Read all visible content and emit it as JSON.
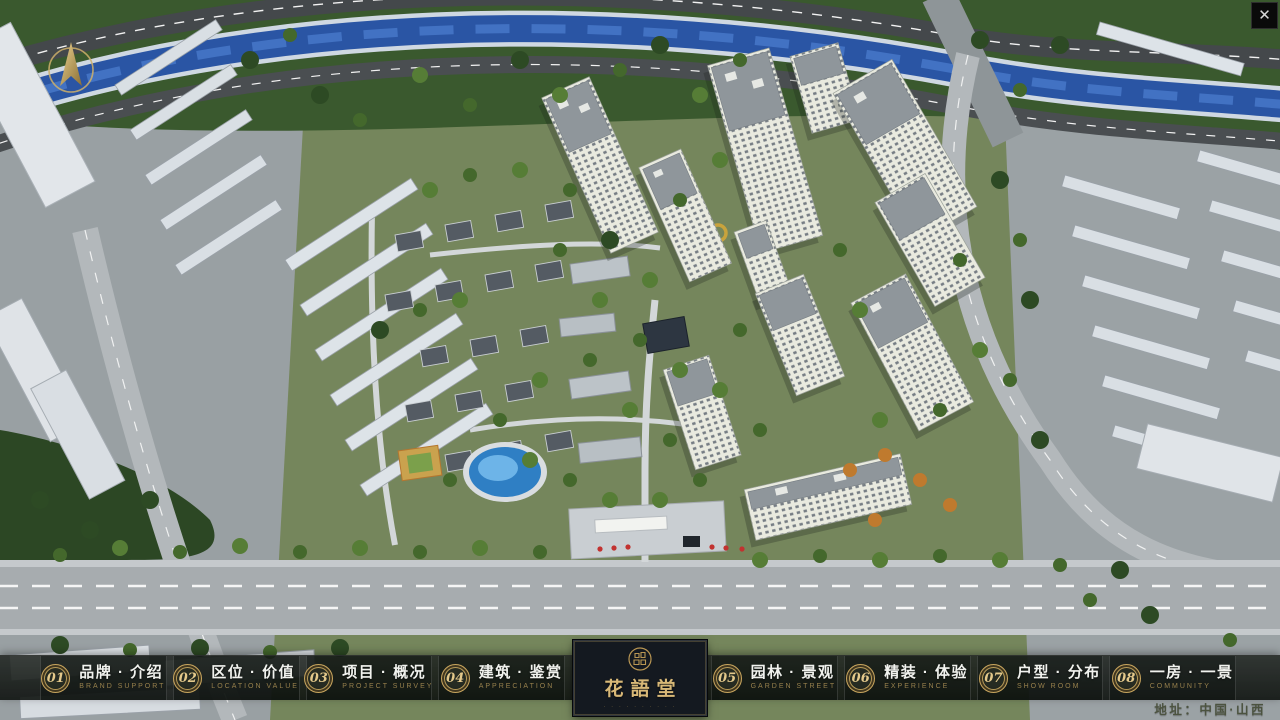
{
  "scene": {
    "type": "3d-aerial-masterplan-render"
  },
  "header": {
    "close_icon": "✕"
  },
  "nav": {
    "items": [
      {
        "num": "01",
        "zh": "品牌 · 介绍",
        "en": "BRAND SUPPORT"
      },
      {
        "num": "02",
        "zh": "区位 · 价值",
        "en": "LOCATION VALUE"
      },
      {
        "num": "03",
        "zh": "项目 · 概况",
        "en": "PROJECT SURVEY"
      },
      {
        "num": "04",
        "zh": "建筑 · 鉴赏",
        "en": "APPRECIATION"
      },
      {
        "num": "05",
        "zh": "园林 · 景观",
        "en": "GARDEN STREET"
      },
      {
        "num": "06",
        "zh": "精装 · 体验",
        "en": "EXPERIENCE"
      },
      {
        "num": "07",
        "zh": "户型 · 分布",
        "en": "SHOW ROOM"
      },
      {
        "num": "08",
        "zh": "一房 · 一景",
        "en": "COMMUNITY"
      }
    ]
  },
  "logo": {
    "name": "花語堂",
    "tagline": "· · · · · · · · · ·"
  },
  "footer": {
    "address": "地址：中国·山西"
  },
  "colors": {
    "gold": "#c8a55e",
    "bar_bg": "#161a17",
    "logo_bg": "#141920",
    "river": "#2a55a4",
    "lawn": "#75865c",
    "text": "#f1f2ee",
    "subtext": "#97804c"
  }
}
